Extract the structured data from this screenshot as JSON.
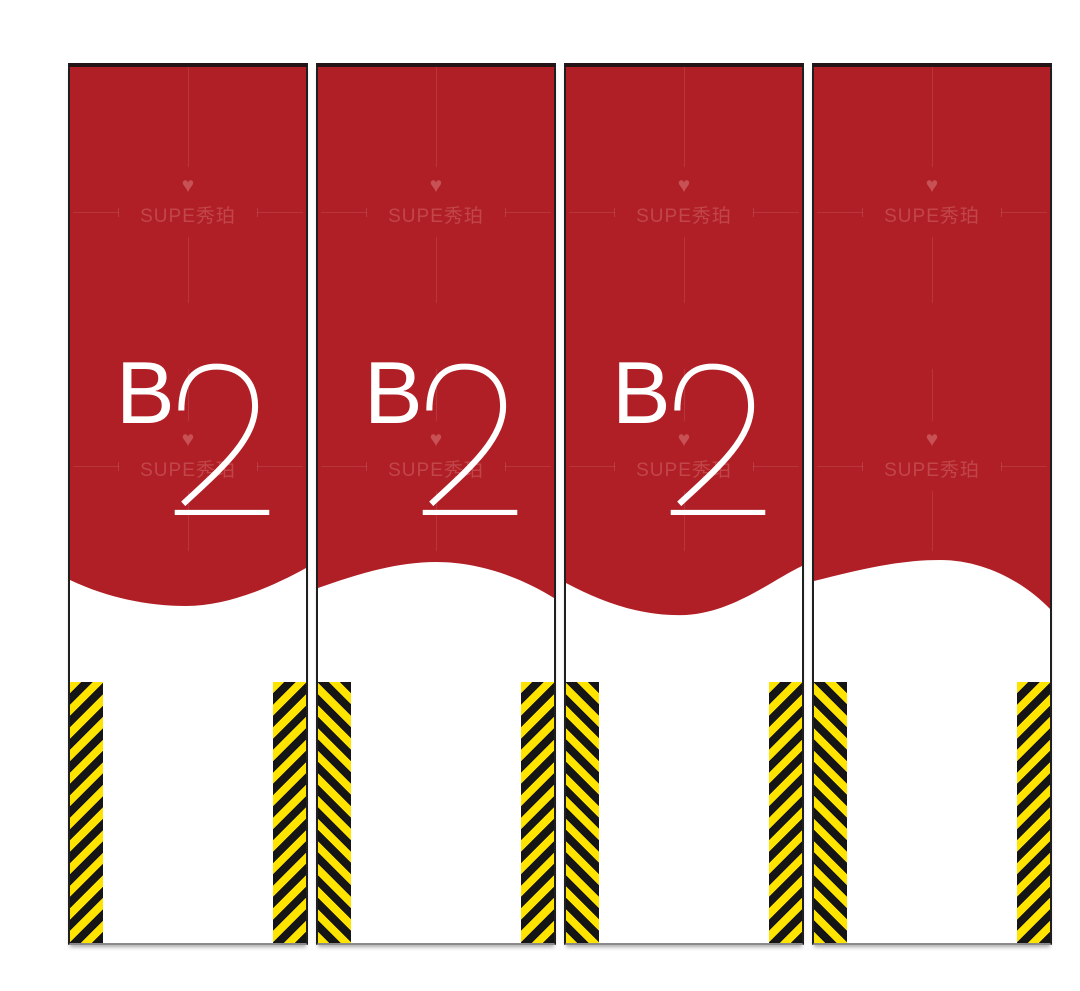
{
  "page": {
    "description": "Four vertical pillar wrap banner design panels",
    "background": "#ffffff"
  },
  "colors": {
    "red": "#B01F25",
    "stripe_yellow": "#FFE400",
    "stripe_black": "#151515",
    "panel_border": "#1f1f1f",
    "text_white": "#ffffff"
  },
  "brand": {
    "heart_icon": "♥",
    "watermark_text": "SUPE秀珀"
  },
  "panels": [
    {
      "name": "pillar-panel-1",
      "floor_label": "B2",
      "floor_letter": "B",
      "floor_number": "2",
      "has_label": true,
      "wave": "trough",
      "wave_path": "M0,0 H236 V14 C200,34 156,52 116,52 C78,52 38,44 0,26 Z",
      "strips": {
        "left": "slash",
        "right": "slash"
      }
    },
    {
      "name": "pillar-panel-2",
      "floor_label": "B2",
      "floor_letter": "B",
      "floor_number": "2",
      "has_label": true,
      "wave": "crest",
      "wave_path": "M0,0 H236 V44 C204,24 162,8 118,8 C76,8 34,22 0,34 Z",
      "strips": {
        "left": "backslash",
        "right": "slash"
      }
    },
    {
      "name": "pillar-panel-3",
      "floor_label": "B2",
      "floor_letter": "B",
      "floor_number": "2",
      "has_label": true,
      "wave": "trough",
      "wave_path": "M0,0 H236 V12 C206,26 168,58 120,61 C76,63 36,48 0,29 Z",
      "strips": {
        "left": "backslash",
        "right": "slash"
      }
    },
    {
      "name": "pillar-panel-4",
      "floor_label": "",
      "floor_letter": "",
      "floor_number": "",
      "has_label": false,
      "wave": "crest",
      "wave_path": "M0,0 H236 V55 C212,30 172,6 126,6 C82,6 40,17 0,27 Z",
      "strips": {
        "left": "backslash",
        "right": "slash"
      }
    }
  ]
}
